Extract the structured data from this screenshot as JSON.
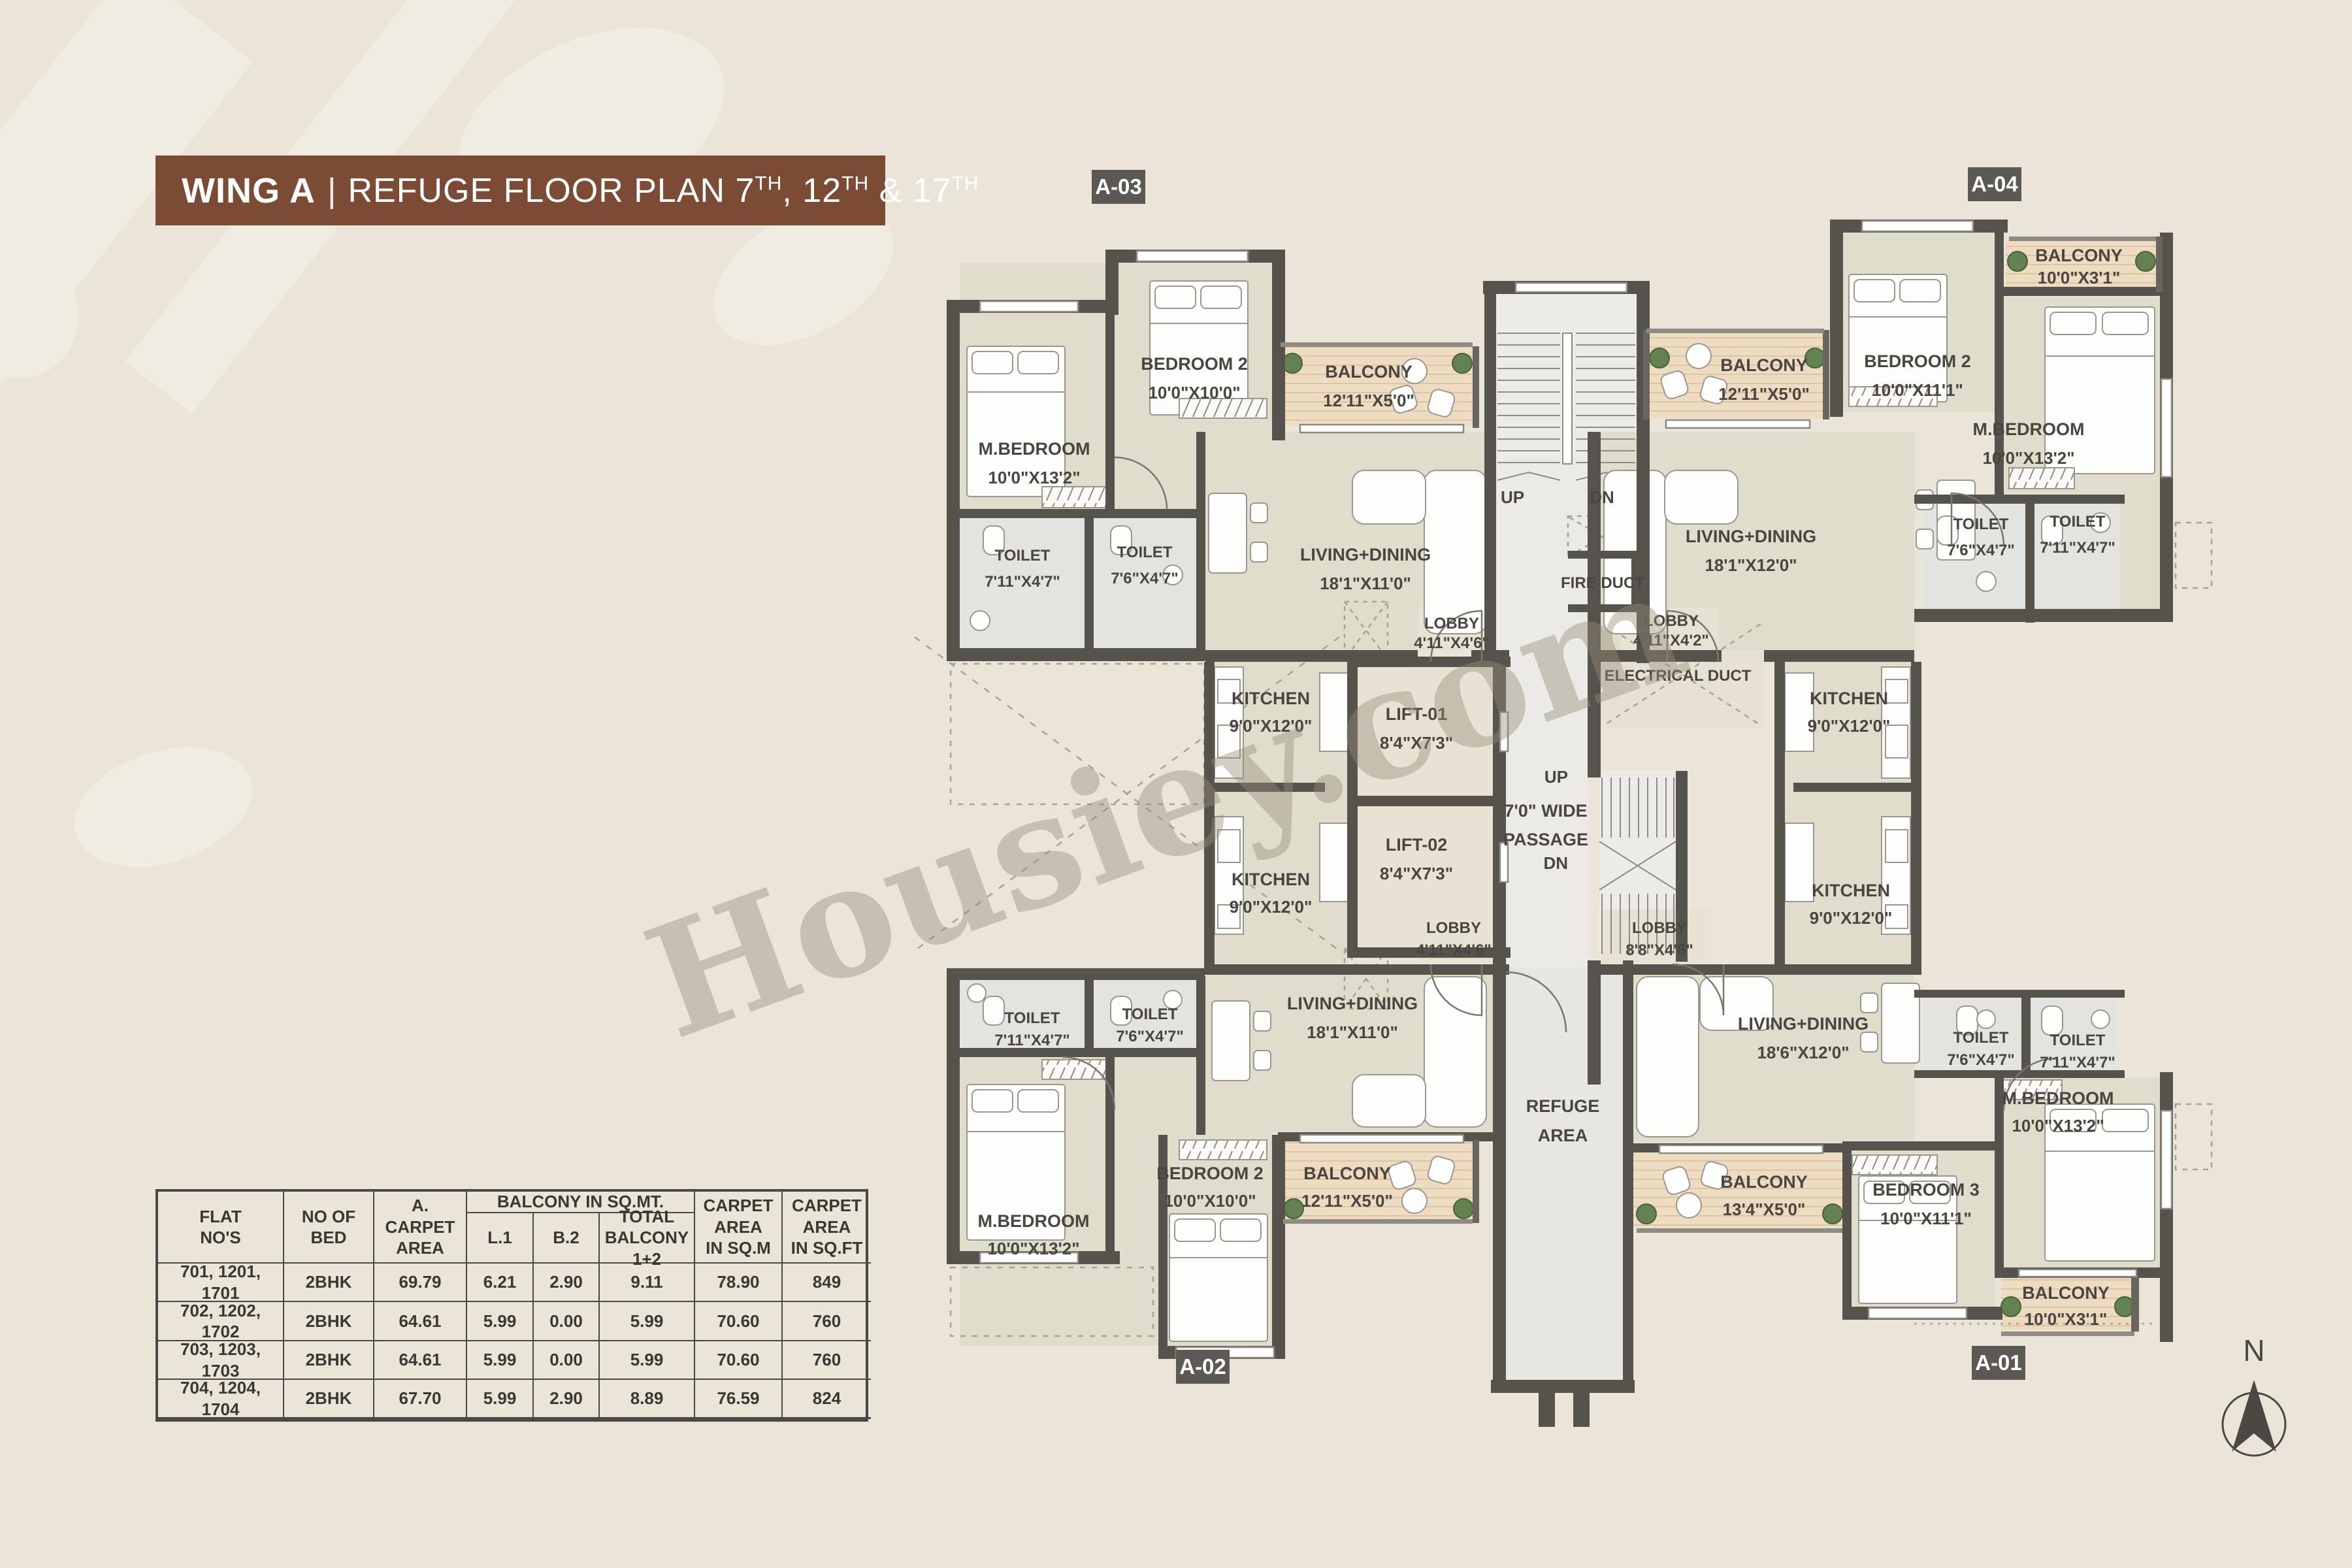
{
  "title": {
    "wing": "WING A",
    "divider": "|",
    "plan": "REFUGE FLOOR PLAN 7",
    "sup1": "TH",
    "mid": ", 12",
    "sup2": "TH",
    "tail": " & 17",
    "sup3": "TH"
  },
  "watermark": "Housiey.com",
  "north_label": "N",
  "badges": {
    "a03": "A-03",
    "a04": "A-04",
    "a02": "A-02",
    "a01": "A-01"
  },
  "colors": {
    "banner": "#7b4b35",
    "wall": "#56524c",
    "floor": "#e1ddcc",
    "balcony_wood": "#eedcc2",
    "toilet": "#e3e4e0",
    "core": "#ecebe7",
    "lift": "#e9e2d4",
    "lobby": "#e8e2d5",
    "refuge": "#e8e6e1",
    "badge": "#5c5853",
    "background": "#eae4d9",
    "label_text": "#4a4540"
  },
  "core": {
    "stair_top_up": "UP",
    "stair_top_dn": "DN",
    "fire_duct": "FIRE DUCT",
    "lift1_name": "LIFT-01",
    "lift1_dims": "8'4\"X7'3\"",
    "lift2_name": "LIFT-02",
    "lift2_dims": "8'4\"X7'3\"",
    "electrical_duct": "ELECTRICAL DUCT",
    "passage1": "7'0\" WIDE",
    "passage2": "PASSAGE",
    "stair_right_up": "UP",
    "stair_right_dn": "DN",
    "refuge1": "REFUGE",
    "refuge2": "AREA"
  },
  "units": {
    "a03": {
      "mbedroom": {
        "name": "M.BEDROOM",
        "dims": "10'0\"X13'2\""
      },
      "bedroom2": {
        "name": "BEDROOM 2",
        "dims": "10'0\"X10'0\""
      },
      "balcony": {
        "name": "BALCONY",
        "dims": "12'11\"X5'0\""
      },
      "toilet1": {
        "name": "TOILET",
        "dims": "7'11\"X4'7\""
      },
      "toilet2": {
        "name": "TOILET",
        "dims": "7'6\"X4'7\""
      },
      "living": {
        "name": "LIVING+DINING",
        "dims": "18'1\"X11'0\""
      },
      "kitchen": {
        "name": "KITCHEN",
        "dims": "9'0\"X12'0\""
      },
      "lobby": {
        "name": "LOBBY",
        "dims": "4'11\"X4'6\""
      }
    },
    "a04": {
      "balcony_left": {
        "name": "BALCONY",
        "dims": "12'11\"X5'0\""
      },
      "bedroom2": {
        "name": "BEDROOM 2",
        "dims": "10'0\"X11'1\""
      },
      "balcony_right": {
        "name": "BALCONY",
        "dims": "10'0\"X3'1\""
      },
      "mbedroom": {
        "name": "M.BEDROOM",
        "dims": "10'0\"X13'2\""
      },
      "living": {
        "name": "LIVING+DINING",
        "dims": "18'1\"X12'0\""
      },
      "toilet1": {
        "name": "TOILET",
        "dims": "7'6\"X4'7\""
      },
      "toilet2": {
        "name": "TOILET",
        "dims": "7'11\"X4'7\""
      },
      "lobby": {
        "name": "LOBBY",
        "dims": "4'11\"X4'2\""
      },
      "kitchen": {
        "name": "KITCHEN",
        "dims": "9'0\"X12'0\""
      }
    },
    "a02": {
      "toilet1": {
        "name": "TOILET",
        "dims": "7'11\"X4'7\""
      },
      "toilet2": {
        "name": "TOILET",
        "dims": "7'6\"X4'7\""
      },
      "living": {
        "name": "LIVING+DINING",
        "dims": "18'1\"X11'0\""
      },
      "mbedroom": {
        "name": "M.BEDROOM",
        "dims": "10'0\"X13'2\""
      },
      "bedroom2": {
        "name": "BEDROOM 2",
        "dims": "10'0\"X10'0\""
      },
      "balcony": {
        "name": "BALCONY",
        "dims": "12'11\"X5'0\""
      },
      "kitchen": {
        "name": "KITCHEN",
        "dims": "9'0\"X12'0\""
      },
      "lobby": {
        "name": "LOBBY",
        "dims": "4'11\"X4'6\""
      }
    },
    "a01": {
      "living": {
        "name": "LIVING+DINING",
        "dims": "18'6\"X12'0\""
      },
      "toilet1": {
        "name": "TOILET",
        "dims": "7'6\"X4'7\""
      },
      "toilet2": {
        "name": "TOILET",
        "dims": "7'11\"X4'7\""
      },
      "mbedroom": {
        "name": "M.BEDROOM",
        "dims": "10'0\"X13'2\""
      },
      "bedroom3": {
        "name": "BEDROOM 3",
        "dims": "10'0\"X11'1\""
      },
      "balcony_main": {
        "name": "BALCONY",
        "dims": "13'4\"X5'0\""
      },
      "balcony_small": {
        "name": "BALCONY",
        "dims": "10'0\"X3'1\""
      },
      "kitchen": {
        "name": "KITCHEN",
        "dims": "9'0\"X12'0\""
      },
      "lobby": {
        "name": "LOBBY",
        "dims": "8'8\"X4'6\""
      }
    }
  },
  "table": {
    "headers": {
      "flat": "FLAT\nNO'S",
      "bed": "NO OF\nBED",
      "carpet": "A.\nCARPET\nAREA",
      "balcony_group": "BALCONY IN SQ.MT.",
      "l1": "L.1",
      "b2": "B.2",
      "total": "TOTAL\nBALCONY\n1+2",
      "sqm": "CARPET\nAREA\nIN SQ.M",
      "sqft": "CARPET\nAREA\nIN SQ.FT"
    },
    "rows": [
      {
        "flat": "701, 1201, 1701",
        "bed": "2BHK",
        "carpet": "69.79",
        "l1": "6.21",
        "b2": "2.90",
        "total": "9.11",
        "sqm": "78.90",
        "sqft": "849"
      },
      {
        "flat": "702, 1202, 1702",
        "bed": "2BHK",
        "carpet": "64.61",
        "l1": "5.99",
        "b2": "0.00",
        "total": "5.99",
        "sqm": "70.60",
        "sqft": "760"
      },
      {
        "flat": "703, 1203, 1703",
        "bed": "2BHK",
        "carpet": "64.61",
        "l1": "5.99",
        "b2": "0.00",
        "total": "5.99",
        "sqm": "70.60",
        "sqft": "760"
      },
      {
        "flat": "704, 1204, 1704",
        "bed": "2BHK",
        "carpet": "67.70",
        "l1": "5.99",
        "b2": "2.90",
        "total": "8.89",
        "sqm": "76.59",
        "sqft": "824"
      }
    ]
  }
}
